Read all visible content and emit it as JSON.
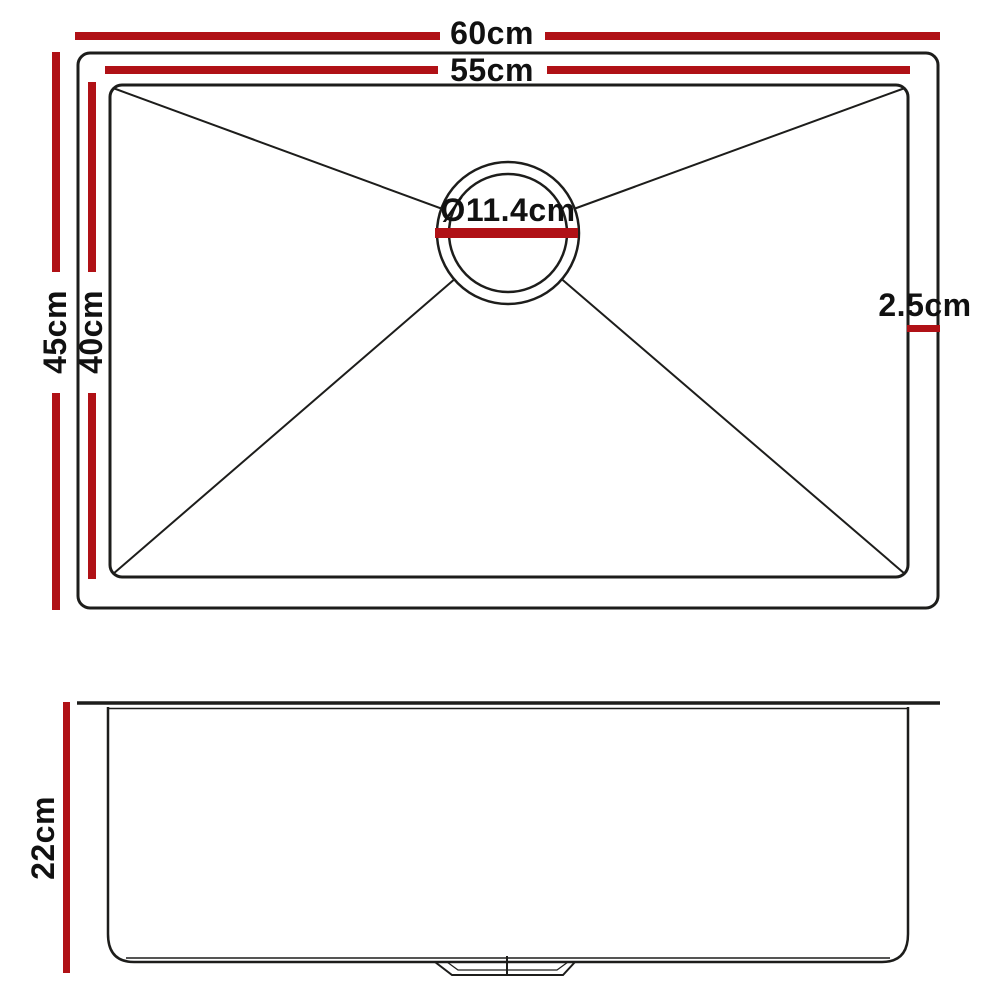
{
  "colors": {
    "dimension_red": "#b01116",
    "line": "#1d1d1b",
    "background": "#ffffff"
  },
  "top_view": {
    "labels": {
      "outer_width": "60cm",
      "inner_width": "55cm",
      "outer_depth": "45cm",
      "inner_depth": "40cm",
      "drain_diameter": "Ø11.4cm",
      "rim_offset": "2.5cm"
    }
  },
  "side_view": {
    "labels": {
      "height": "22cm"
    }
  }
}
